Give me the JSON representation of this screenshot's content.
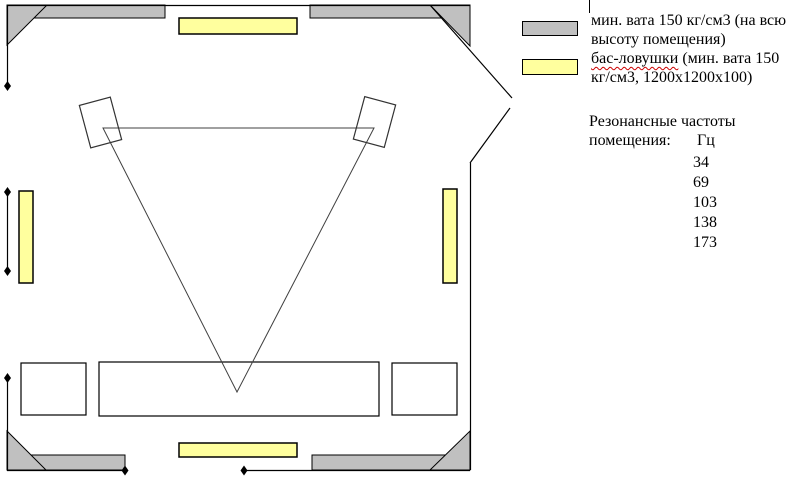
{
  "colors": {
    "mineral_wool": "#c0c0c0",
    "bass_trap": "#ffff9e",
    "wall": "#000000",
    "misspell_underline": "#cc0000"
  },
  "legend": {
    "mineral_wool_label": "мин. вата 150 кг/см3 (на всю высоту помещения)",
    "bass_trap_term": "бас-ловушки",
    "bass_trap_rest": " (мин. вата 150 кг/см3, 1200x1200x100)"
  },
  "resonance": {
    "title_line1": "Резонансные частоты",
    "title_line2": "помещения:",
    "unit": "Гц",
    "frequencies": [
      "34",
      "69",
      "103",
      "138",
      "173"
    ]
  }
}
